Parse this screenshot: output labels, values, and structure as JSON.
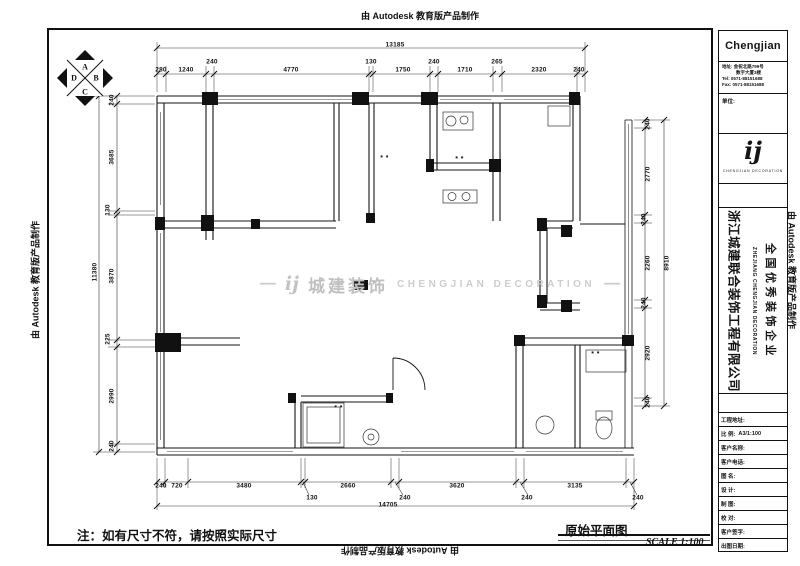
{
  "stamps": {
    "text": "由 Autodesk 教育版产品制作"
  },
  "north_arrow": {
    "letters": [
      "A",
      "B",
      "C",
      "D"
    ]
  },
  "watermark": {
    "dash": "—",
    "logo": "ij",
    "cn": "城建装饰",
    "en": "CHENGJIAN DECORATION"
  },
  "note": "注：如有尺寸不符，请按照实际尺寸",
  "drawing_title": {
    "name": "原始平面图",
    "scale": "SCALE 1:100"
  },
  "colors": {
    "line": "#141414",
    "watermark_gray": "#c3c3c3"
  },
  "room_labels": [
    {
      "text": "■ ■",
      "x": 385,
      "y": 156
    },
    {
      "text": "■ ■",
      "x": 460,
      "y": 157
    },
    {
      "text": "■ ■",
      "x": 596,
      "y": 352
    },
    {
      "text": "■ ■",
      "x": 339,
      "y": 406
    }
  ],
  "dims": {
    "top": {
      "overall": {
        "t": "13185",
        "x": 395,
        "y": 45
      },
      "segs": [
        {
          "t": "280",
          "x": 161,
          "y": 70
        },
        {
          "t": "1240",
          "x": 186,
          "y": 70
        },
        {
          "t": "240",
          "x": 212,
          "y": 62
        },
        {
          "t": "4770",
          "x": 291,
          "y": 70
        },
        {
          "t": "130",
          "x": 371,
          "y": 62
        },
        {
          "t": "1750",
          "x": 403,
          "y": 70
        },
        {
          "t": "240",
          "x": 434,
          "y": 62
        },
        {
          "t": "1710",
          "x": 465,
          "y": 70
        },
        {
          "t": "265",
          "x": 497,
          "y": 62
        },
        {
          "t": "2320",
          "x": 539,
          "y": 70
        },
        {
          "t": "240",
          "x": 579,
          "y": 70
        }
      ]
    },
    "left": {
      "overall": {
        "t": "11380",
        "x": 95,
        "y": 272
      },
      "segs": [
        {
          "t": "240",
          "x": 112,
          "y": 100
        },
        {
          "t": "3685",
          "x": 112,
          "y": 157
        },
        {
          "t": "130",
          "x": 108,
          "y": 210
        },
        {
          "t": "3870",
          "x": 112,
          "y": 276
        },
        {
          "t": "225",
          "x": 108,
          "y": 339
        },
        {
          "t": "2990",
          "x": 112,
          "y": 396
        },
        {
          "t": "240",
          "x": 112,
          "y": 446
        }
      ]
    },
    "right": {
      "overall": {
        "t": "8910",
        "x": 667,
        "y": 263
      },
      "segs": [
        {
          "t": "240",
          "x": 648,
          "y": 124
        },
        {
          "t": "2770",
          "x": 648,
          "y": 174
        },
        {
          "t": "240",
          "x": 644,
          "y": 219
        },
        {
          "t": "2260",
          "x": 648,
          "y": 263
        },
        {
          "t": "240",
          "x": 644,
          "y": 303
        },
        {
          "t": "2920",
          "x": 648,
          "y": 353
        },
        {
          "t": "240",
          "x": 648,
          "y": 402
        }
      ]
    },
    "bottom": {
      "overall": {
        "t": "14705",
        "x": 388,
        "y": 505
      },
      "segs": [
        {
          "t": "240",
          "x": 161,
          "y": 486
        },
        {
          "t": "720",
          "x": 177,
          "y": 486
        },
        {
          "t": "3480",
          "x": 244,
          "y": 486
        },
        {
          "t": "130",
          "x": 312,
          "y": 498
        },
        {
          "t": "2660",
          "x": 348,
          "y": 486
        },
        {
          "t": "240",
          "x": 405,
          "y": 498
        },
        {
          "t": "3620",
          "x": 457,
          "y": 486
        },
        {
          "t": "240",
          "x": 527,
          "y": 498
        },
        {
          "t": "3135",
          "x": 575,
          "y": 486
        },
        {
          "t": "240",
          "x": 638,
          "y": 498
        }
      ]
    }
  },
  "title_block": {
    "brand": "Chengjian",
    "address_line1": "地址: 金祝北路799号",
    "address_line2": "数字大厦3楼",
    "tel": "Tel: 0571-88151688",
    "fax": "Fax: 0571-88151688",
    "unit_label": "单位:",
    "logo_glyph": "ij",
    "logo_caption": "CHENGJIAN DECORATION",
    "company_cn": "浙江城建联合装饰工程有限公司",
    "company_en": "ZHEJIANG CHENGJIAN DECORATION",
    "honor": "全国优秀装饰企业",
    "rows": [
      {
        "label": "工程地址:",
        "value": ""
      },
      {
        "label": "比 例:",
        "value": "A3/1:100"
      },
      {
        "label": "客户名称:",
        "value": ""
      },
      {
        "label": "客户电话:",
        "value": ""
      },
      {
        "label": "图 名:",
        "value": ""
      },
      {
        "label": "设 计:",
        "value": ""
      },
      {
        "label": "制 图:",
        "value": ""
      },
      {
        "label": "校 对:",
        "value": ""
      },
      {
        "label": "客户签字:",
        "value": ""
      },
      {
        "label": "出图日期:",
        "value": ""
      }
    ]
  }
}
